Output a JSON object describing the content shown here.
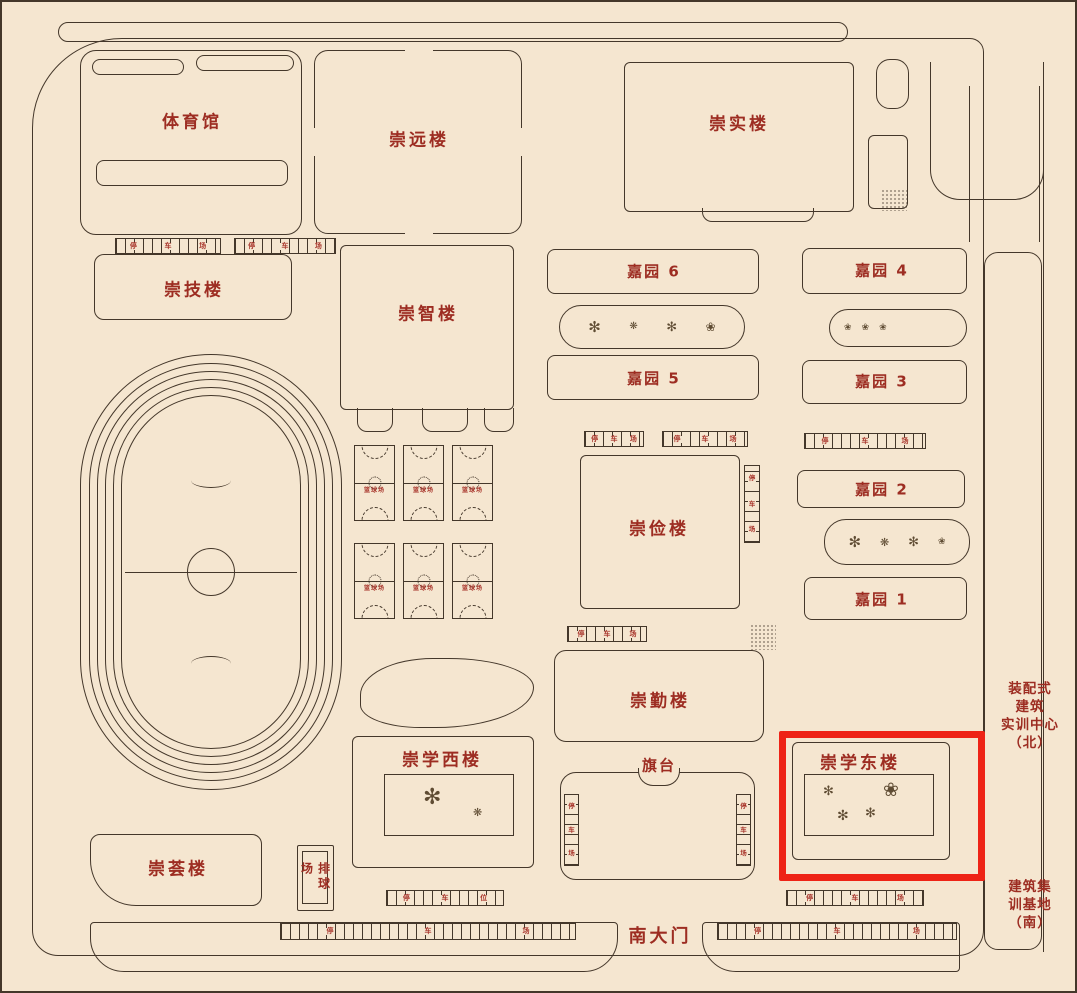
{
  "title": "校园平面图",
  "palette": {
    "background": "#f5e6d0",
    "outline": "#44372a",
    "label": "#9d2d22",
    "highlight": "#ee2316"
  },
  "labels": {
    "gym": "体育馆",
    "chongyuan": "崇远楼",
    "chongshi": "崇实楼",
    "chongji": "崇技楼",
    "chongzhi": "崇智楼",
    "chongjian": "崇俭楼",
    "chongqin": "崇勤楼",
    "chongxue_west": "崇学西楼",
    "chongxue_east": "崇学东楼",
    "chonghui": "崇荟楼",
    "jiayuan6": "嘉园 6",
    "jiayuan5": "嘉园 5",
    "jiayuan4": "嘉园 4",
    "jiayuan3": "嘉园 3",
    "jiayuan2": "嘉园 2",
    "jiayuan1": "嘉园 1",
    "basketball": "篮球场",
    "volleyball": "排球场",
    "flag_platform": "旗台",
    "south_gate": "南大门"
  },
  "parking": {
    "lot_chars": [
      "停",
      "车",
      "场"
    ],
    "spot_chars": [
      "停",
      "车",
      "位"
    ]
  },
  "annotations": {
    "north_facility_lines": [
      "装配式",
      "建筑",
      "实训中心",
      "（北）"
    ],
    "south_facility_lines": [
      "建筑集",
      "训基地",
      "（南）"
    ],
    "tree_icon": "✻",
    "flower_icon": "❀",
    "shrub_icon": "❋"
  }
}
